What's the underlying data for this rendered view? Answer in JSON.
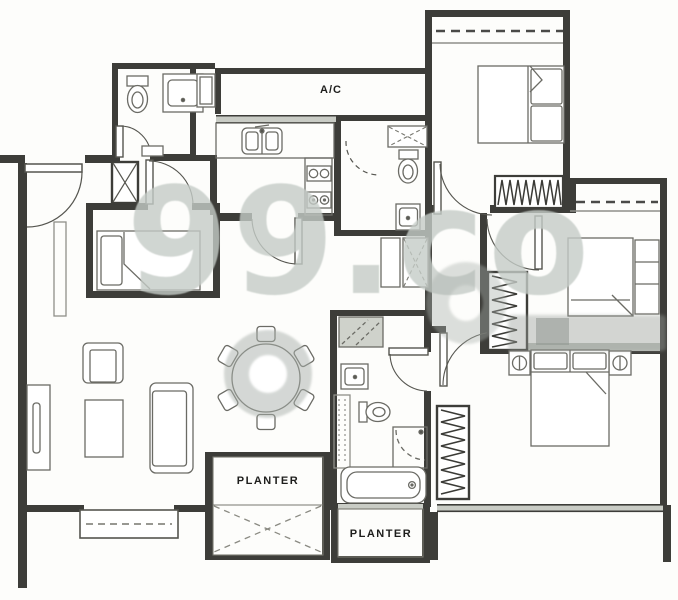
{
  "image": {
    "kind": "scanned apartment floor plan",
    "width": 678,
    "height": 600
  },
  "labels": {
    "ac": "A/C",
    "planter_left": "PLANTER",
    "planter_bottom": "PLANTER"
  },
  "watermark": {
    "text": "99.co"
  },
  "colors": {
    "paper": "#fdfdfb",
    "wall": "#3d3d39",
    "furniture_line": "#6b6b65",
    "light_line": "#8f8f89",
    "window_fill": "#c9ccc5",
    "hatch_fill": "#cfd2cb",
    "label_text": "#1e1e1c",
    "watermark_gray": "#c5ccc7"
  },
  "icons": [
    "toilet-icon",
    "vanity-sink-icon",
    "kitchen-sink-icon",
    "stove-hob-icon",
    "fridge-icon",
    "shower-icon",
    "bathtub-icon",
    "wardrobe-icon",
    "single-bed-icon",
    "double-bed-icon",
    "nightstand-lamp-icon",
    "dining-table-icon",
    "dining-chair-icon",
    "sofa-icon",
    "armchair-icon",
    "coffee-table-icon",
    "tv-console-icon",
    "door-swing-icon",
    "shaft-x-icon"
  ]
}
